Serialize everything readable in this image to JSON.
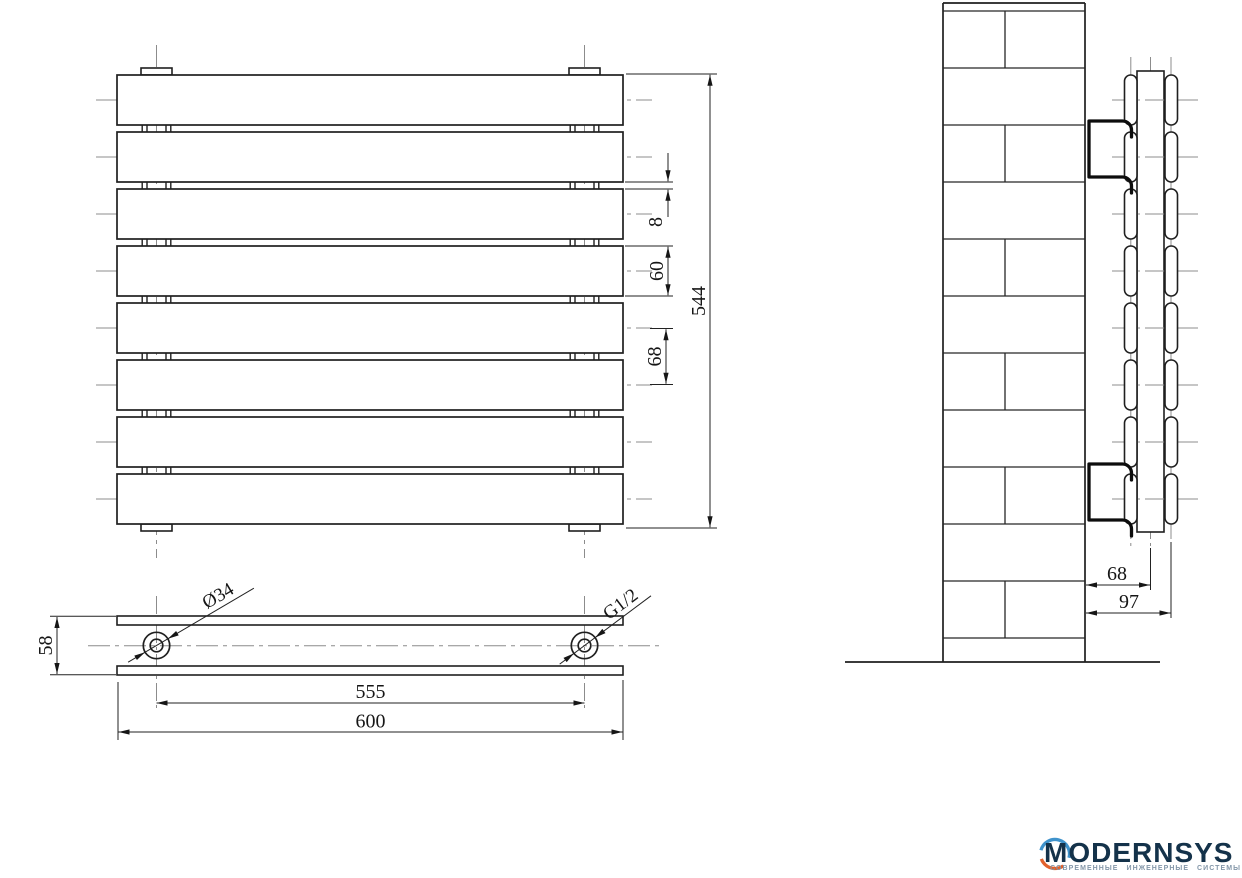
{
  "front_view": {
    "dim_gap": "8",
    "dim_panel_height": "60",
    "dim_pitch": "68",
    "dim_total_height": "544"
  },
  "bottom_view": {
    "dim_depth": "58",
    "dim_collector_diameter": "Ø34",
    "dim_thread": "G1/2",
    "dim_port_spacing": "555",
    "dim_total_length": "600"
  },
  "side_view": {
    "dim_wall_to_collector": "68",
    "dim_wall_to_front": "97"
  },
  "logo": {
    "brand": "MODERNSYS",
    "tagline": "СОВРЕМЕННЫЕ ИНЖЕНЕРНЫЕ СИСТЕМЫ",
    "navy": "#14324a",
    "accent_blue": "#3f93cc",
    "accent_orange": "#e2612c"
  }
}
